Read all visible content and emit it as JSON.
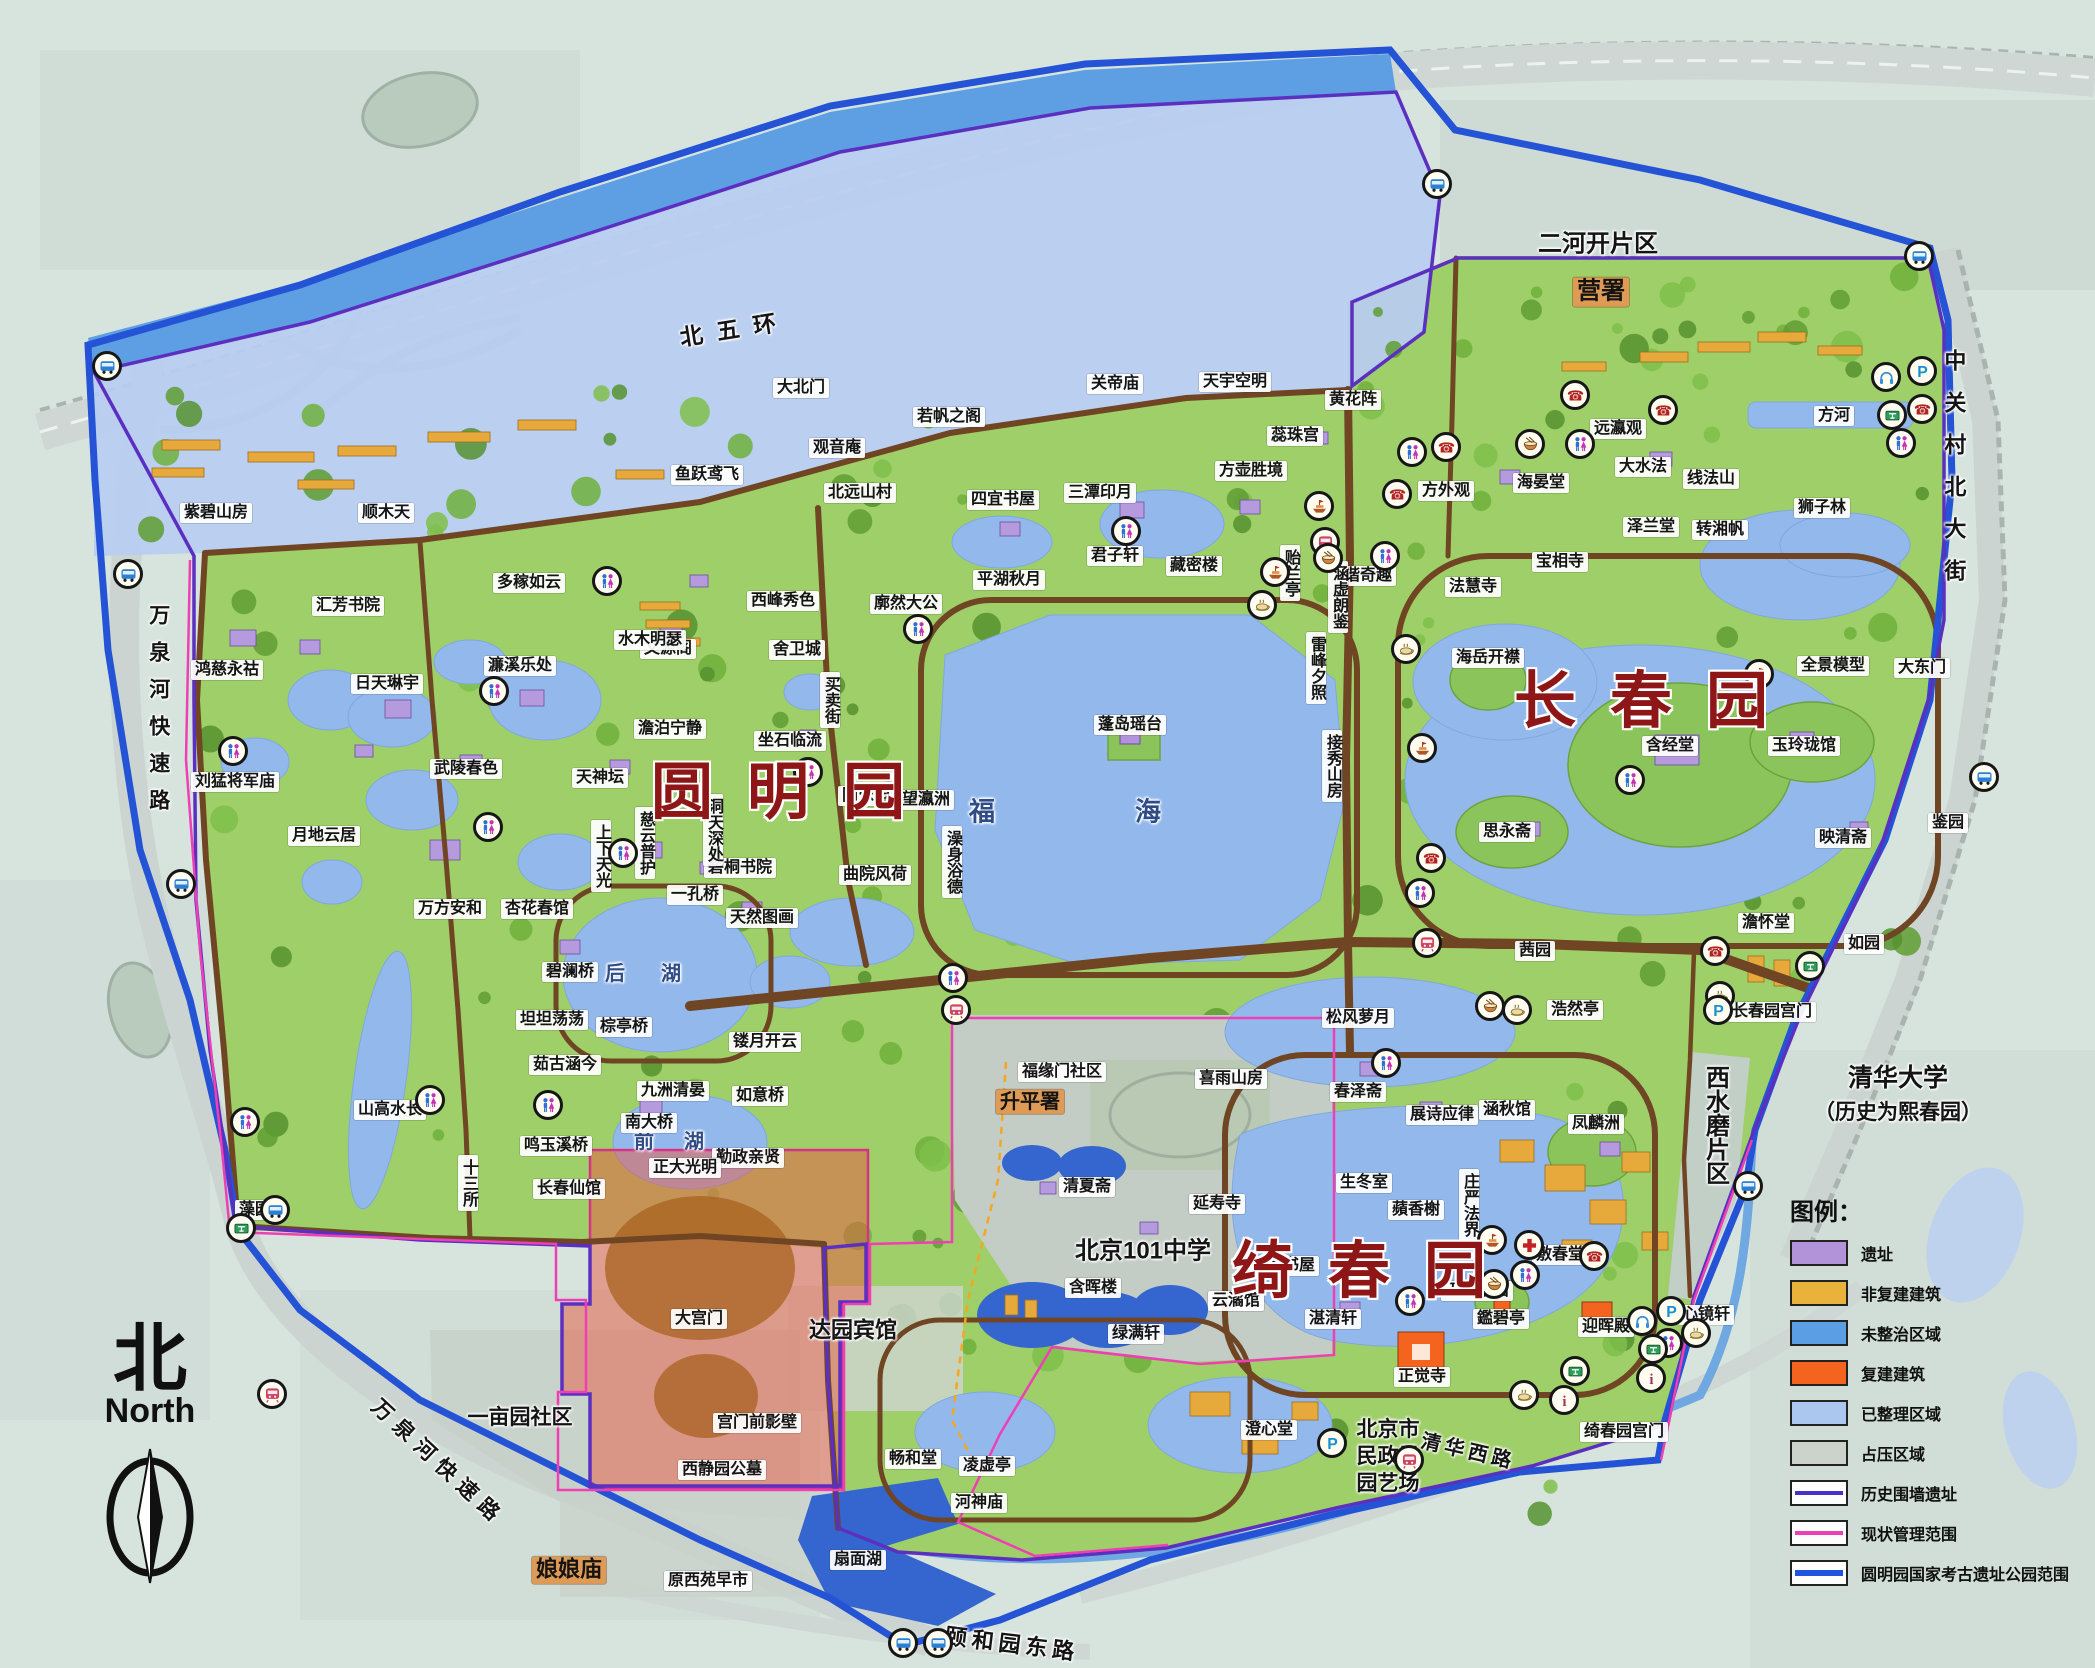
{
  "gardens": [
    {
      "name": "圆明园",
      "x": 795,
      "y": 786
    },
    {
      "name": "长春园",
      "x": 1658,
      "y": 695
    },
    {
      "name": "绮春园",
      "x": 1376,
      "y": 1265
    }
  ],
  "compass": {
    "zh": "北",
    "en": "North"
  },
  "legend": {
    "title": "图例：",
    "items": [
      {
        "label": "遗址",
        "type": "fill",
        "color": "#b293d9"
      },
      {
        "label": "非复建建筑",
        "type": "fill",
        "color": "#e9b33b"
      },
      {
        "label": "未整治区域",
        "type": "fill",
        "color": "#5b9ee4"
      },
      {
        "label": "复建建筑",
        "type": "fill",
        "color": "#f4641e"
      },
      {
        "label": "已整理区域",
        "type": "fill",
        "color": "#abc7ef"
      },
      {
        "label": "占压区域",
        "type": "fill",
        "color": "#ccd3cb"
      },
      {
        "label": "历史围墙遗址",
        "type": "line",
        "color": "#4331c9"
      },
      {
        "label": "现状管理范围",
        "type": "line",
        "color": "#ef3fb4"
      },
      {
        "label": "圆明园国家考古遗址公园范围",
        "type": "thickline",
        "color": "#1f54e0"
      }
    ]
  },
  "roads": [
    {
      "t": "北五环",
      "x": 735,
      "y": 330,
      "b": "n",
      "s": 23,
      "ls": 14,
      "r": -9
    },
    {
      "t": "万泉河快速路",
      "x": 158,
      "y": 715,
      "b": "n",
      "s": 21,
      "ls": 16,
      "v": 1
    },
    {
      "t": "万泉河快速路",
      "x": 438,
      "y": 1463,
      "b": "n",
      "s": 21,
      "ls": 8,
      "r": 43
    },
    {
      "t": "中关村北大街",
      "x": 1953,
      "y": 475,
      "b": "n",
      "s": 22,
      "ls": 20,
      "v": 1
    },
    {
      "t": "颐和园东路",
      "x": 1012,
      "y": 1645,
      "b": "n",
      "s": 22,
      "ls": 5,
      "r": 7
    },
    {
      "t": "清华西路",
      "x": 1468,
      "y": 1452,
      "b": "n",
      "s": 20,
      "ls": 4,
      "r": 13
    }
  ],
  "labels": [
    {
      "t": "紫碧山房",
      "x": 216,
      "y": 513
    },
    {
      "t": "顺木天",
      "x": 386,
      "y": 513
    },
    {
      "t": "汇芳书院",
      "x": 348,
      "y": 606
    },
    {
      "t": "多稼如云",
      "x": 529,
      "y": 583
    },
    {
      "t": "鸿慈永祜",
      "x": 227,
      "y": 670
    },
    {
      "t": "文源阁",
      "x": 668,
      "y": 649
    },
    {
      "t": "西峰秀色",
      "x": 783,
      "y": 601
    },
    {
      "t": "鱼跃鸢飞",
      "x": 707,
      "y": 475
    },
    {
      "t": "大北门",
      "x": 801,
      "y": 388
    },
    {
      "t": "观音庵",
      "x": 837,
      "y": 448
    },
    {
      "t": "若帆之阁",
      "x": 949,
      "y": 417
    },
    {
      "t": "北远山村",
      "x": 860,
      "y": 493
    },
    {
      "t": "关帝庙",
      "x": 1115,
      "y": 384
    },
    {
      "t": "天宇空明",
      "x": 1235,
      "y": 382
    },
    {
      "t": "黄花阵",
      "x": 1353,
      "y": 400
    },
    {
      "t": "蕊珠宫",
      "x": 1295,
      "y": 436
    },
    {
      "t": "方壶胜境",
      "x": 1251,
      "y": 471
    },
    {
      "t": "三潭印月",
      "x": 1100,
      "y": 493
    },
    {
      "t": "四宜书屋",
      "x": 1003,
      "y": 500
    },
    {
      "t": "平湖秋月",
      "x": 1009,
      "y": 580
    },
    {
      "t": "君子轩",
      "x": 1115,
      "y": 556
    },
    {
      "t": "藏密楼",
      "x": 1194,
      "y": 566
    },
    {
      "t": "远瀛观",
      "x": 1618,
      "y": 429
    },
    {
      "t": "大水法",
      "x": 1643,
      "y": 467
    },
    {
      "t": "线法山",
      "x": 1711,
      "y": 479
    },
    {
      "t": "方外观",
      "x": 1446,
      "y": 491
    },
    {
      "t": "海晏堂",
      "x": 1541,
      "y": 483
    },
    {
      "t": "泽兰堂",
      "x": 1651,
      "y": 527
    },
    {
      "t": "转湘帆",
      "x": 1720,
      "y": 530
    },
    {
      "t": "宝相寺",
      "x": 1560,
      "y": 562
    },
    {
      "t": "法慧寺",
      "x": 1473,
      "y": 587
    },
    {
      "t": "谐奇趣",
      "x": 1368,
      "y": 576
    },
    {
      "t": "狮子林",
      "x": 1822,
      "y": 508
    },
    {
      "t": "方河",
      "x": 1834,
      "y": 416
    },
    {
      "t": "全景模型",
      "x": 1833,
      "y": 666
    },
    {
      "t": "大东门",
      "x": 1922,
      "y": 668
    },
    {
      "t": "海岳开襟",
      "x": 1488,
      "y": 658
    },
    {
      "t": "思永斋",
      "x": 1507,
      "y": 832
    },
    {
      "t": "含经堂",
      "x": 1670,
      "y": 746
    },
    {
      "t": "玉玲珑馆",
      "x": 1804,
      "y": 746
    },
    {
      "t": "映清斋",
      "x": 1843,
      "y": 838
    },
    {
      "t": "鉴园",
      "x": 1948,
      "y": 823
    },
    {
      "t": "茜园",
      "x": 1535,
      "y": 951
    },
    {
      "t": "澹怀堂",
      "x": 1766,
      "y": 923
    },
    {
      "t": "如园",
      "x": 1864,
      "y": 944
    },
    {
      "t": "浩然亭",
      "x": 1575,
      "y": 1010
    },
    {
      "t": "长春园宫门",
      "x": 1772,
      "y": 1012
    },
    {
      "t": "贻兰亭",
      "x": 1290,
      "y": 573,
      "v": 1
    },
    {
      "t": "涵虚朗鉴",
      "x": 1338,
      "y": 597,
      "v": 1
    },
    {
      "t": "雷峰夕照",
      "x": 1316,
      "y": 668,
      "v": 1
    },
    {
      "t": "接秀山房",
      "x": 1332,
      "y": 766,
      "v": 1
    },
    {
      "t": "蓬岛瑶台",
      "x": 1130,
      "y": 725
    },
    {
      "t": "福海",
      "x": 1135,
      "y": 812,
      "b": "n",
      "s": 26,
      "ls": 140,
      "c": "#2f4c87"
    },
    {
      "t": "澡身浴德",
      "x": 952,
      "y": 862,
      "v": 1
    },
    {
      "t": "曲院风荷",
      "x": 875,
      "y": 875
    },
    {
      "t": "廓然大公",
      "x": 906,
      "y": 604
    },
    {
      "t": "舍卫城",
      "x": 797,
      "y": 650
    },
    {
      "t": "水木明瑟",
      "x": 650,
      "y": 640
    },
    {
      "t": "澹泊宁静",
      "x": 670,
      "y": 729
    },
    {
      "t": "坐石临流",
      "x": 790,
      "y": 741
    },
    {
      "t": "买卖街",
      "x": 830,
      "y": 700,
      "v": 1
    },
    {
      "t": "同乐园",
      "x": 866,
      "y": 796
    },
    {
      "t": "望瀛洲",
      "x": 926,
      "y": 800
    },
    {
      "t": "濂溪乐处",
      "x": 520,
      "y": 666
    },
    {
      "t": "日天琳宇",
      "x": 387,
      "y": 684
    },
    {
      "t": "武陵春色",
      "x": 466,
      "y": 769
    },
    {
      "t": "刘猛将军庙",
      "x": 235,
      "y": 782
    },
    {
      "t": "月地云居",
      "x": 324,
      "y": 836
    },
    {
      "t": "天神坛",
      "x": 600,
      "y": 778
    },
    {
      "t": "慈云普护",
      "x": 645,
      "y": 843,
      "v": 1
    },
    {
      "t": "上下天光",
      "x": 601,
      "y": 856,
      "v": 1
    },
    {
      "t": "杏花春馆",
      "x": 537,
      "y": 909
    },
    {
      "t": "万方安和",
      "x": 450,
      "y": 909
    },
    {
      "t": "碧澜桥",
      "x": 570,
      "y": 972
    },
    {
      "t": "坦坦荡荡",
      "x": 552,
      "y": 1020
    },
    {
      "t": "茹古涵今",
      "x": 565,
      "y": 1065
    },
    {
      "t": "棕亭桥",
      "x": 624,
      "y": 1027
    },
    {
      "t": "后湖",
      "x": 661,
      "y": 974,
      "b": "n",
      "s": 20,
      "ls": 36,
      "c": "#2f4c87"
    },
    {
      "t": "前湖",
      "x": 684,
      "y": 1142,
      "b": "n",
      "s": 20,
      "ls": 30,
      "c": "#2f4c87"
    },
    {
      "t": "九洲清晏",
      "x": 673,
      "y": 1091
    },
    {
      "t": "南大桥",
      "x": 649,
      "y": 1123
    },
    {
      "t": "鸣玉溪桥",
      "x": 556,
      "y": 1146
    },
    {
      "t": "长春仙馆",
      "x": 569,
      "y": 1189
    },
    {
      "t": "山高水长",
      "x": 390,
      "y": 1110
    },
    {
      "t": "十三所",
      "x": 468,
      "y": 1183,
      "v": 1
    },
    {
      "t": "一孔桥",
      "x": 695,
      "y": 895
    },
    {
      "t": "碧桐书院",
      "x": 740,
      "y": 868
    },
    {
      "t": "天然图画",
      "x": 762,
      "y": 918
    },
    {
      "t": "洞天深处",
      "x": 713,
      "y": 830,
      "v": 1
    },
    {
      "t": "镂月开云",
      "x": 765,
      "y": 1042
    },
    {
      "t": "如意桥",
      "x": 760,
      "y": 1096
    },
    {
      "t": "勤政亲贤",
      "x": 748,
      "y": 1158
    },
    {
      "t": "藻园",
      "x": 255,
      "y": 1210
    },
    {
      "t": "正大光明",
      "x": 685,
      "y": 1168
    },
    {
      "t": "大宫门",
      "x": 699,
      "y": 1319
    },
    {
      "t": "宫门前影壁",
      "x": 757,
      "y": 1423
    },
    {
      "t": "西静园公墓",
      "x": 722,
      "y": 1470
    },
    {
      "t": "达园宾馆",
      "x": 853,
      "y": 1331,
      "b": "n",
      "s": 22
    },
    {
      "t": "一亩园社区",
      "x": 520,
      "y": 1418,
      "b": "n",
      "s": 21
    },
    {
      "t": "娘娘庙",
      "x": 569,
      "y": 1570,
      "b": "o",
      "s": 22
    },
    {
      "t": "原西苑早市",
      "x": 708,
      "y": 1581
    },
    {
      "t": "扇面湖",
      "x": 858,
      "y": 1560
    },
    {
      "t": "北京市",
      "x": 1388,
      "y": 1430,
      "b": "n",
      "s": 21
    },
    {
      "t": "民政局",
      "x": 1388,
      "y": 1457,
      "b": "n",
      "s": 21
    },
    {
      "t": "园艺场",
      "x": 1388,
      "y": 1484,
      "b": "n",
      "s": 21
    },
    {
      "t": "福缘门社区",
      "x": 1062,
      "y": 1072
    },
    {
      "t": "升平署",
      "x": 1030,
      "y": 1102,
      "b": "o",
      "s": 20
    },
    {
      "t": "喜雨山房",
      "x": 1231,
      "y": 1079
    },
    {
      "t": "清夏斋",
      "x": 1087,
      "y": 1187
    },
    {
      "t": "延寿寺",
      "x": 1217,
      "y": 1204
    },
    {
      "t": "北京101中学",
      "x": 1143,
      "y": 1252,
      "b": "n",
      "s": 24
    },
    {
      "t": "含晖楼",
      "x": 1093,
      "y": 1288
    },
    {
      "t": "云潏馆",
      "x": 1236,
      "y": 1301
    },
    {
      "t": "四宜书屋",
      "x": 1283,
      "y": 1266
    },
    {
      "t": "松风萝月",
      "x": 1358,
      "y": 1018
    },
    {
      "t": "春泽斋",
      "x": 1358,
      "y": 1092
    },
    {
      "t": "展诗应律",
      "x": 1442,
      "y": 1115
    },
    {
      "t": "涵秋馆",
      "x": 1507,
      "y": 1110
    },
    {
      "t": "凤麟洲",
      "x": 1596,
      "y": 1124
    },
    {
      "t": "生冬室",
      "x": 1364,
      "y": 1183
    },
    {
      "t": "蘋香榭",
      "x": 1416,
      "y": 1210
    },
    {
      "t": "庄严法界",
      "x": 1469,
      "y": 1205,
      "v": 1
    },
    {
      "t": "天心水面",
      "x": 1477,
      "y": 1291
    },
    {
      "t": "敷春堂",
      "x": 1560,
      "y": 1255
    },
    {
      "t": "湛清轩",
      "x": 1333,
      "y": 1319
    },
    {
      "t": "鑑碧亭",
      "x": 1501,
      "y": 1319
    },
    {
      "t": "正觉寺",
      "x": 1422,
      "y": 1377
    },
    {
      "t": "迎晖殿",
      "x": 1606,
      "y": 1327
    },
    {
      "t": "心镜轩",
      "x": 1706,
      "y": 1315
    },
    {
      "t": "澄心堂",
      "x": 1269,
      "y": 1430
    },
    {
      "t": "畅和堂",
      "x": 913,
      "y": 1459
    },
    {
      "t": "凌虚亭",
      "x": 987,
      "y": 1466
    },
    {
      "t": "河神庙",
      "x": 979,
      "y": 1503
    },
    {
      "t": "绿满轩",
      "x": 1136,
      "y": 1334
    },
    {
      "t": "绮春园宫门",
      "x": 1624,
      "y": 1432
    },
    {
      "t": "西水磨片区",
      "x": 1714,
      "y": 1125,
      "v": 1,
      "b": "n",
      "s": 24
    },
    {
      "t": "清华大学",
      "x": 1898,
      "y": 1078,
      "b": "n",
      "s": 25
    },
    {
      "t": "（历史为熙春园）",
      "x": 1898,
      "y": 1113,
      "b": "n",
      "s": 21
    },
    {
      "t": "二河开片区",
      "x": 1598,
      "y": 245,
      "b": "n",
      "s": 24
    },
    {
      "t": "营署",
      "x": 1601,
      "y": 292,
      "b": "o",
      "s": 24
    }
  ],
  "icons": [
    [
      "wc",
      607,
      581
    ],
    [
      "wc",
      918,
      629
    ],
    [
      "wc",
      808,
      772
    ],
    [
      "wc",
      233,
      751
    ],
    [
      "wc",
      494,
      691
    ],
    [
      "wc",
      488,
      827
    ],
    [
      "wc",
      623,
      853
    ],
    [
      "wc",
      430,
      1100
    ],
    [
      "wc",
      548,
      1105
    ],
    [
      "wc",
      245,
      1122
    ],
    [
      "wc",
      1410,
      1301
    ],
    [
      "wc",
      1386,
      1063
    ],
    [
      "wc",
      953,
      978
    ],
    [
      "wc",
      1525,
      1275
    ],
    [
      "wc",
      1668,
      1343
    ],
    [
      "wc",
      1630,
      780
    ],
    [
      "wc",
      1580,
      444
    ],
    [
      "wc",
      1412,
      452
    ],
    [
      "wc",
      1126,
      531
    ],
    [
      "wc",
      1385,
      556
    ],
    [
      "wc",
      1420,
      893
    ],
    [
      "wc",
      1901,
      443
    ],
    [
      "bus",
      107,
      366
    ],
    [
      "bus",
      128,
      574
    ],
    [
      "bus",
      181,
      884
    ],
    [
      "bus",
      275,
      1210
    ],
    [
      "bus",
      903,
      1643
    ],
    [
      "bus",
      938,
      1643
    ],
    [
      "bus",
      1437,
      184
    ],
    [
      "bus",
      1919,
      256
    ],
    [
      "bus",
      1984,
      777
    ],
    [
      "bus",
      1748,
      1186
    ],
    [
      "metro",
      272,
      1394
    ],
    [
      "metro",
      1325,
      542
    ],
    [
      "metro",
      1427,
      943
    ],
    [
      "metro",
      956,
      1010
    ],
    [
      "metro",
      1409,
      1460
    ],
    [
      "phone",
      1575,
      395
    ],
    [
      "phone",
      1663,
      410
    ],
    [
      "phone",
      1446,
      447
    ],
    [
      "phone",
      1397,
      494
    ],
    [
      "phone",
      1431,
      858
    ],
    [
      "phone",
      1715,
      951
    ],
    [
      "phone",
      1594,
      1256
    ],
    [
      "phone",
      1922,
      409
    ],
    [
      "tea",
      1262,
      605
    ],
    [
      "tea",
      1406,
      649
    ],
    [
      "tea",
      1517,
      1010
    ],
    [
      "tea",
      1720,
      996
    ],
    [
      "tea",
      1696,
      1333
    ],
    [
      "tea",
      1524,
      1395
    ],
    [
      "bowl",
      1530,
      444
    ],
    [
      "bowl",
      1328,
      558
    ],
    [
      "bowl",
      1490,
      1006
    ],
    [
      "bowl",
      1494,
      1284
    ],
    [
      "boat",
      1319,
      506
    ],
    [
      "boat",
      1275,
      572
    ],
    [
      "boat",
      1422,
      748
    ],
    [
      "boat",
      1759,
      674
    ],
    [
      "boat",
      1492,
      1240
    ],
    [
      "p",
      1922,
      371
    ],
    [
      "p",
      1718,
      1010
    ],
    [
      "p",
      1332,
      1443
    ],
    [
      "p",
      1671,
      1311
    ],
    [
      "t",
      1892,
      415
    ],
    [
      "t",
      241,
      1228
    ],
    [
      "t",
      1810,
      966
    ],
    [
      "t",
      1575,
      1371
    ],
    [
      "t",
      1653,
      1349
    ],
    [
      "i",
      1564,
      1400
    ],
    [
      "i",
      1651,
      1378
    ],
    [
      "cross",
      1529,
      1245
    ],
    [
      "headphone",
      1886,
      377
    ],
    [
      "headphone",
      1642,
      1321
    ]
  ]
}
